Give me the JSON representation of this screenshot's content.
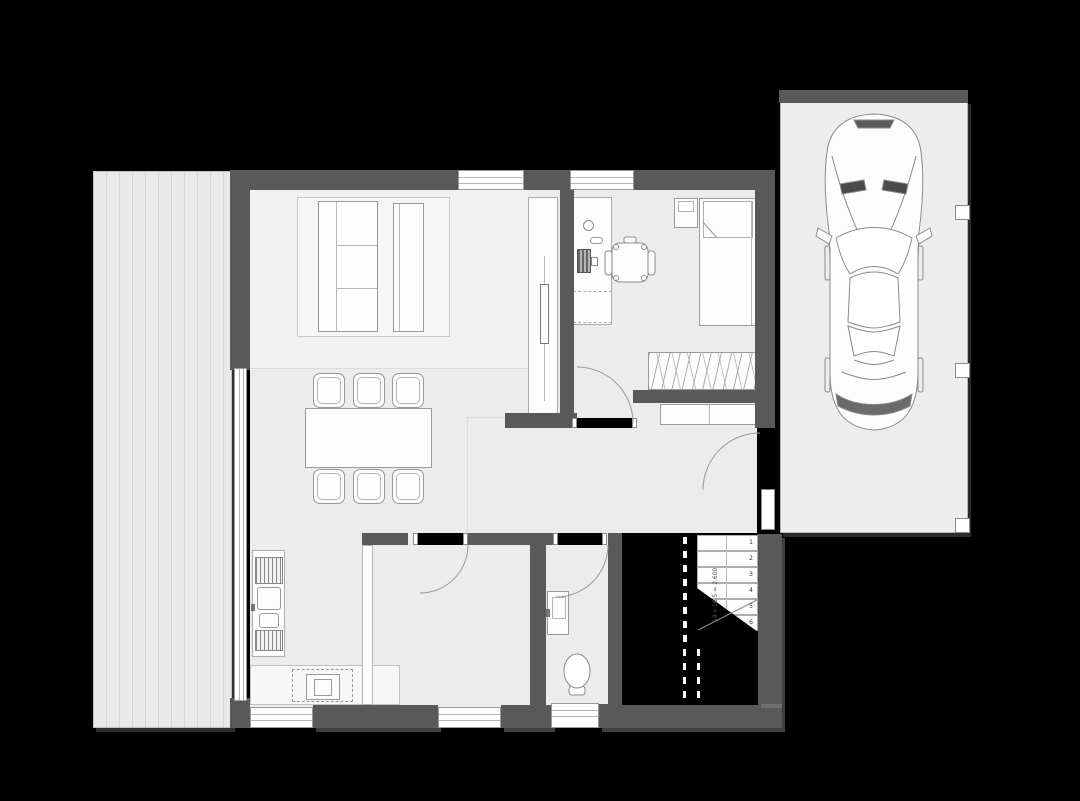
{
  "palette": {
    "background": "#000000",
    "wall": "#595959",
    "wall_core": "#000000",
    "floor": "#ececec",
    "floor_lounge": "#f1f1f1",
    "garage_floor": "#ededed",
    "deck_board": "#e9e9e9",
    "deck_gap": "#d5d5d5",
    "drawing_line": "#9a9a9a",
    "furniture_fill": "#fdfdfd"
  },
  "areas": {
    "deck": "wood deck / terrace",
    "living_dining": "living and dining area",
    "kitchen": "kitchen",
    "bedroom_office": "bedroom with desk nook",
    "hall": "entrance hall",
    "utility": "utility room",
    "bathroom": "bathroom",
    "stairwell": "stairwell void",
    "garage": "garage / carport"
  },
  "furniture": {
    "living": [
      "rug",
      "sofa",
      "daybed",
      "tv-sideboard",
      "dining-table",
      "six-stools"
    ],
    "kitchen": [
      "counter-with-sink",
      "cooktop",
      "fireplace-stove"
    ],
    "bedroom": [
      "bed",
      "pillow",
      "nightstand",
      "wardrobe",
      "desk",
      "monitor",
      "office-chair"
    ],
    "hall": [
      "sideboard",
      "entrance-door"
    ],
    "bathroom": [
      "vanity-sink",
      "toilet"
    ],
    "garage": [
      "car-top-view",
      "roof-posts"
    ]
  },
  "stairs": {
    "steps": [
      "1",
      "2",
      "3",
      "4",
      "5",
      "6"
    ],
    "dimension_label": "18 x 18.5 = 2.600"
  }
}
